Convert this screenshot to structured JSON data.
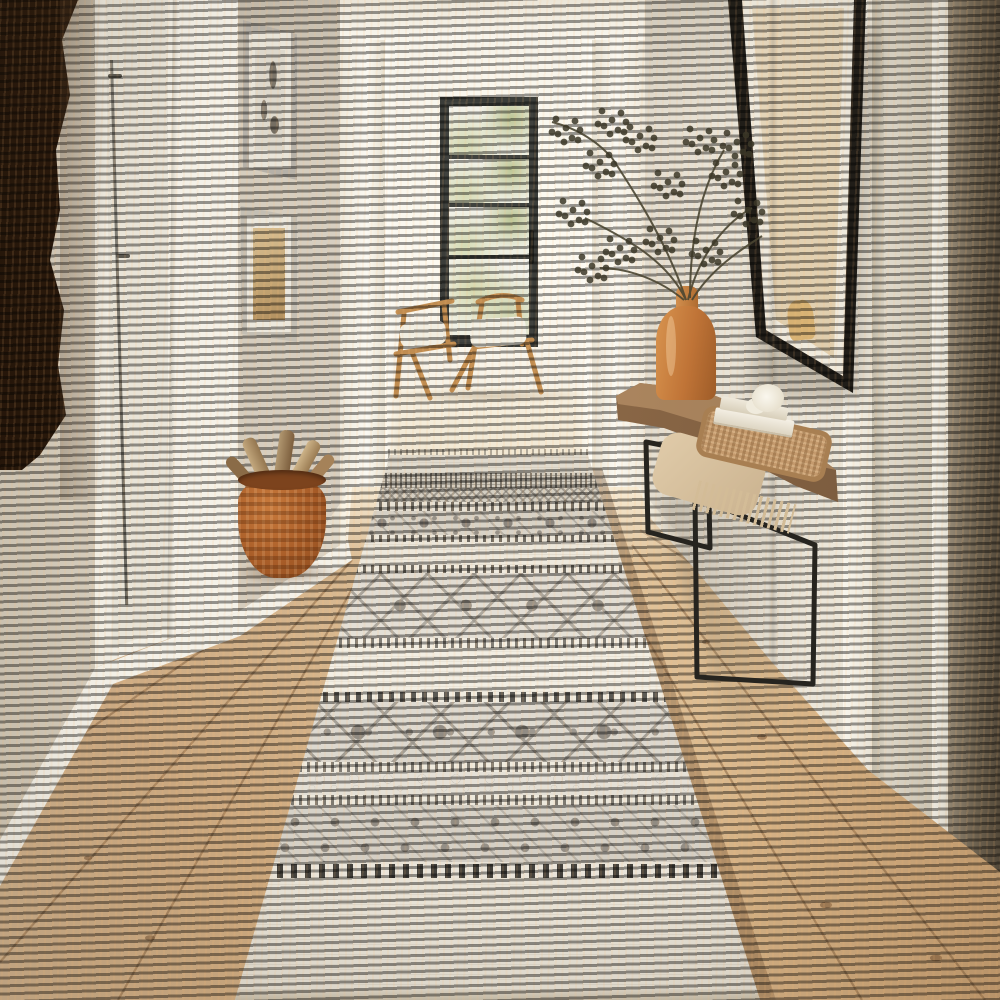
{
  "meta": {
    "description": "Product photograph of a bohemian cream-and-grey geometric runner rug laid down a bright hallway with warm oak wood floors; a glass door and two wooden chairs are visible in the far room, a live-edge console table with books, woven tray, throw blanket and terracotta vase with dried branches stands on the right, framed art hangs on both walls, a woven basket of firewood sits by the left door and a dark tree-trunk sculpture edges the left foreground."
  },
  "palette": {
    "wallLeft": "#d6cec0",
    "wallRight": "#ece7db",
    "trimWhite": "#f7f4ea",
    "farRoom": "#faf7ef",
    "doorBlack": "#3b3d39",
    "floorWood": "#c79d6f",
    "floorPale": "#ead9bd",
    "rugCream": "#f0ebdf",
    "rugGray": "#a59f95",
    "rugDark": "#6f6a61",
    "rugInk": "#32302b",
    "chairWood": "#c08c50",
    "trunkDark": "#3c2412",
    "basketTerracotta": "#a95d28",
    "consoleWood": "#8a6746",
    "metalLeg": "#26241f",
    "vaseTerracotta": "#c07437",
    "branchOlive": "#3c3828",
    "throwTan": "#d8c3a1",
    "artworkTan": "#dcc8a4"
  },
  "scene": {
    "objects": [
      {
        "name": "runner-rug",
        "label": "boho geometric runner rug"
      },
      {
        "name": "hall-floor",
        "label": "oak plank hallway floor"
      },
      {
        "name": "doorway",
        "label": "open doorway to bright room"
      },
      {
        "name": "black-glass-door",
        "label": "black framed glass door"
      },
      {
        "name": "wooden-chairs",
        "label": "two wooden chairs with white cushions"
      },
      {
        "name": "console-table",
        "label": "live-edge console with black metal legs"
      },
      {
        "name": "vase-branches",
        "label": "terracotta vase with dried branches"
      },
      {
        "name": "firewood-basket",
        "label": "woven basket with firewood"
      },
      {
        "name": "right-artwork",
        "label": "large black framed botanical art"
      },
      {
        "name": "left-frames",
        "label": "two small framed prints"
      },
      {
        "name": "tree-trunk",
        "label": "dark tree trunk sculpture"
      }
    ]
  },
  "rug": {
    "bands": [
      {
        "kind": "cream",
        "top": 0.0,
        "h": 3.3
      },
      {
        "kind": "dense",
        "top": 3.3,
        "h": 2.7
      },
      {
        "kind": "dense2",
        "top": 6.0,
        "h": 2.6
      },
      {
        "kind": "dash",
        "top": 8.6,
        "h": 1.7
      },
      {
        "kind": "floral-small",
        "top": 10.3,
        "h": 4.4
      },
      {
        "kind": "dash",
        "top": 14.7,
        "h": 1.3
      },
      {
        "kind": "cream",
        "top": 16.0,
        "h": 4.2
      },
      {
        "kind": "dash",
        "top": 20.2,
        "h": 1.5
      },
      {
        "kind": "diamond",
        "top": 21.7,
        "h": 11.9
      },
      {
        "kind": "dash",
        "top": 33.6,
        "h": 1.8
      },
      {
        "kind": "cream",
        "top": 35.4,
        "h": 8.1
      },
      {
        "kind": "dash-bold",
        "top": 43.5,
        "h": 1.8
      },
      {
        "kind": "floral-bold",
        "top": 45.3,
        "h": 11.0
      },
      {
        "kind": "dash",
        "top": 56.3,
        "h": 1.9
      },
      {
        "kind": "vine",
        "top": 58.2,
        "h": 4.2
      },
      {
        "kind": "dash",
        "top": 62.4,
        "h": 1.8
      },
      {
        "kind": "damask",
        "top": 64.2,
        "h": 10.5
      },
      {
        "kind": "piano",
        "top": 74.7,
        "h": 3.3
      },
      {
        "kind": "cream",
        "top": 78.0,
        "h": 20.2
      },
      {
        "kind": "edge",
        "top": 98.2,
        "h": 1.8
      }
    ]
  },
  "floor": {
    "planks": [
      [
        648,
        520,
        1000,
        640
      ],
      [
        640,
        530,
        1000,
        760
      ],
      [
        632,
        545,
        985,
        1000
      ],
      [
        600,
        560,
        862,
        1000
      ],
      [
        345,
        550,
        0,
        792
      ],
      [
        352,
        560,
        0,
        962
      ],
      [
        360,
        575,
        118,
        1000
      ],
      [
        368,
        592,
        330,
        1000
      ],
      [
        490,
        472,
        560,
        1000
      ]
    ],
    "knots": [
      [
        762,
        737,
        5
      ],
      [
        826,
        905,
        6
      ],
      [
        706,
        642,
        4
      ],
      [
        936,
        958,
        6
      ],
      [
        150,
        938,
        5
      ],
      [
        88,
        858,
        4
      ],
      [
        540,
        700,
        3
      ]
    ]
  },
  "plant": {
    "clusters": [
      [
        600,
        162
      ],
      [
        573,
        210
      ],
      [
        640,
        136
      ],
      [
        668,
        182
      ],
      [
        700,
        138
      ],
      [
        726,
        172
      ],
      [
        748,
        210
      ],
      [
        620,
        248
      ],
      [
        592,
        266
      ],
      [
        660,
        238
      ],
      [
        706,
        250
      ],
      [
        737,
        142
      ],
      [
        612,
        120
      ],
      [
        566,
        128
      ]
    ],
    "offsets": [
      [
        0,
        0
      ],
      [
        9,
        -7
      ],
      [
        -8,
        6
      ],
      [
        6,
        10
      ],
      [
        -10,
        -9
      ],
      [
        14,
        2
      ],
      [
        -2,
        14
      ],
      [
        12,
        12
      ],
      [
        -14,
        4
      ]
    ]
  }
}
